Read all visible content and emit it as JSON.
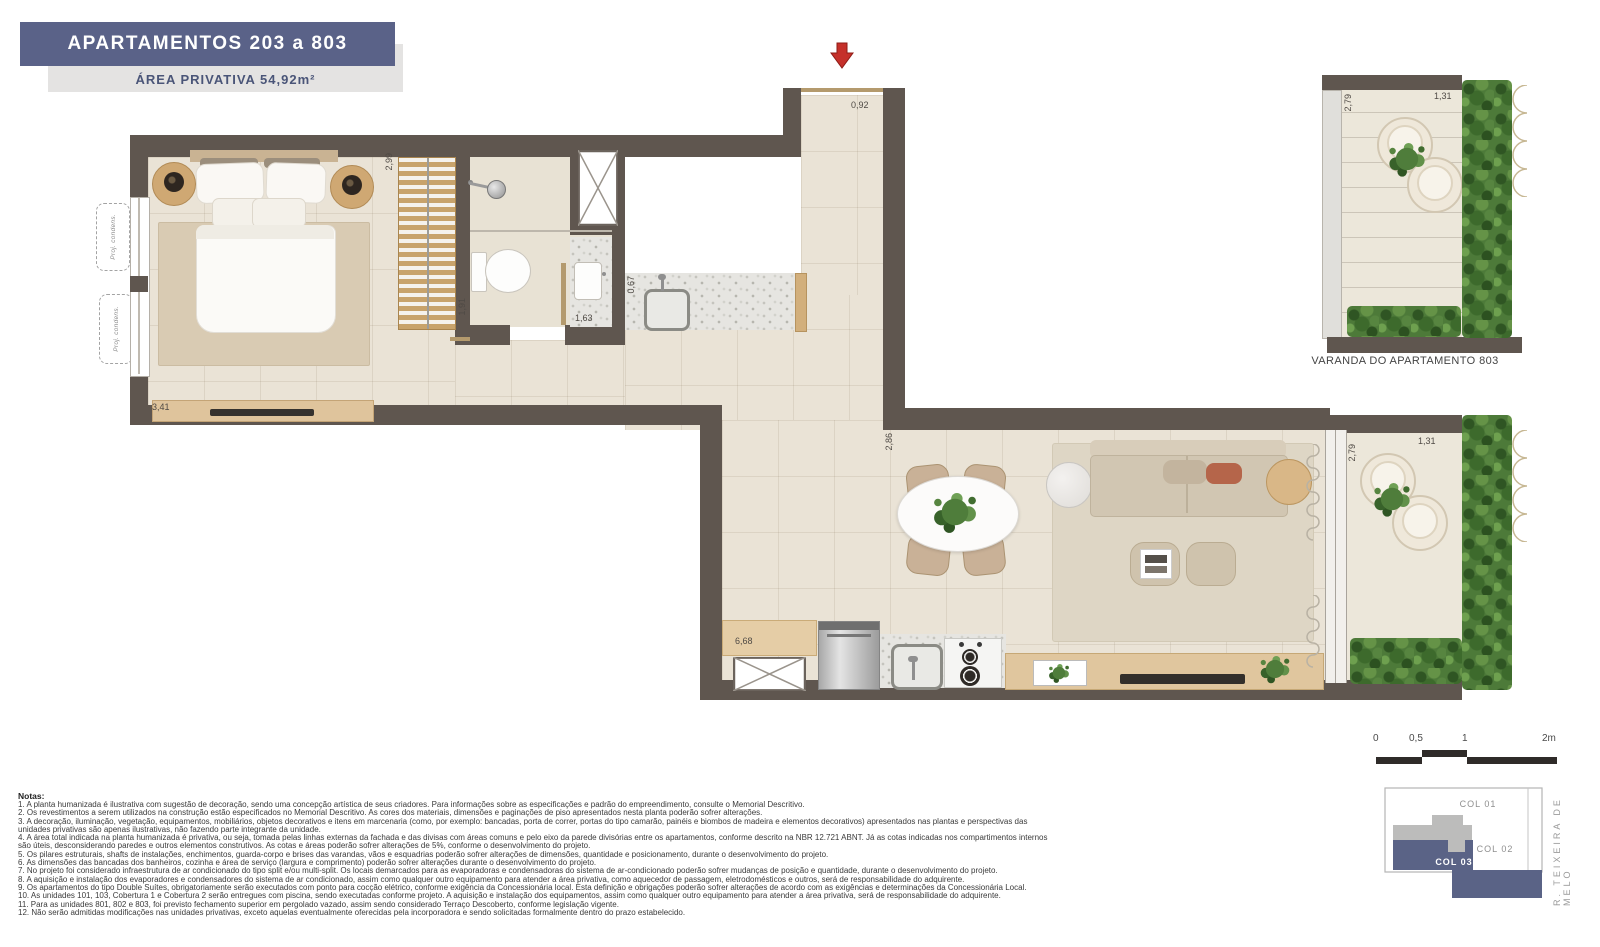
{
  "header": {
    "title": "APARTAMENTOS 203 a 803",
    "subtitle": "ÁREA PRIVATIVA 54,92m²"
  },
  "plan": {
    "dims": {
      "bedroom_width": "3,41",
      "wardrobe_width": "2,99",
      "bathroom_depth": "1,91",
      "vanity_width": "1,63",
      "counter_depth": "0,67",
      "entrance_width": "0,92",
      "living_width": "2,86",
      "kitchen_length": "6,68",
      "balcony_depth": "2,79",
      "balcony_width": "1,31"
    },
    "condenser_label": "Proj. condens."
  },
  "varanda": {
    "label": "VARANDA DO APARTAMENTO 803",
    "depth": "2,79",
    "width": "1,31"
  },
  "scale_bar": {
    "ticks": [
      "0",
      "0,5",
      "1",
      "2m"
    ]
  },
  "key_plan": {
    "col01": "COL 01",
    "col02": "COL 02",
    "col03": "COL 03",
    "street": "R. TEIXEIRA DE MELO"
  },
  "notes": {
    "title": "Notas:",
    "items": [
      "1. A planta humanizada é ilustrativa com sugestão de decoração, sendo uma concepção artística de seus criadores. Para informações sobre as especificações e padrão do empreendimento, consulte o Memorial Descritivo.",
      "2. Os revestimentos a serem utilizados na construção estão especificados no Memorial Descritivo. As cores dos materiais, dimensões e paginações de piso apresentados nesta planta poderão sofrer alterações.",
      "3. A decoração, iluminação, vegetação, equipamentos, mobiliários, objetos decorativos e itens em marcenaria (como, por exemplo: bancadas, porta de correr, portas do tipo camarão, painéis e biombos de madeira e elementos decorativos) apresentados nas plantas e perspectivas das unidades privativas são apenas ilustrativas, não fazendo parte integrante da unidade.",
      "4. A área total indicada na planta humanizada é privativa, ou seja, tomada pelas linhas externas da fachada e das divisas com áreas comuns e pelo eixo da parede divisórias entre os apartamentos, conforme descrito na NBR 12.721 ABNT. Já as cotas indicadas nos compartimentos internos são úteis, desconsiderando paredes e outros elementos construtivos. As cotas e áreas poderão sofrer alterações de 5%, conforme o desenvolvimento do projeto.",
      "5. Os pilares estruturais, shafts de instalações, enchimentos, guarda-corpo e brises das varandas, vãos e esquadrias poderão sofrer alterações de dimensões, quantidade e posicionamento, durante o desenvolvimento do projeto.",
      "6. As dimensões das bancadas dos banheiros, cozinha e área de serviço (largura e comprimento) poderão sofrer alterações durante o desenvolvimento do projeto.",
      "7. No projeto foi considerado infraestrutura de ar condicionado do tipo split e/ou multi-split. Os locais demarcados para as evaporadoras e condensadoras do sistema de ar-condicionado poderão sofrer mudanças de posição e quantidade, durante o desenvolvimento do projeto.",
      "8. A aquisição e instalação dos evaporadores e condensadores do sistema de ar condicionado, assim como qualquer outro equipamento para atender a área privativa, como aquecedor de passagem, eletrodomésticos e outros, será de responsabilidade do adquirente.",
      "9. Os apartamentos do tipo Double Suítes, obrigatoriamente serão executados com ponto para cocção elétrico, conforme exigência da Concessionária local. Esta definição e obrigações poderão sofrer alterações de acordo com as exigências e determinações da Concessionária Local.",
      "10. As unidades 101, 103, Cobertura 1 e Cobertura 2 serão entregues com piscina, sendo executadas conforme projeto. A aquisição e instalação dos equipamentos, assim como qualquer outro equipamento para atender a área privativa, será de responsabilidade do adquirente.",
      "11. Para as unidades 801, 802 e 803, foi previsto fechamento superior em pergolado vazado, assim sendo considerado Terraço Descoberto, conforme legislação vigente.",
      "12. Não serão admitidas modificações nas unidades privativas, exceto aquelas eventualmente oferecidas pela incorporadora e sendo solicitadas formalmente dentro do prazo estabelecido."
    ]
  },
  "colors": {
    "banner_blue": "#5a6288",
    "wall": "#5f564f",
    "keyplan_blue": "#5a6386",
    "arrow_red": "#c5302a"
  }
}
